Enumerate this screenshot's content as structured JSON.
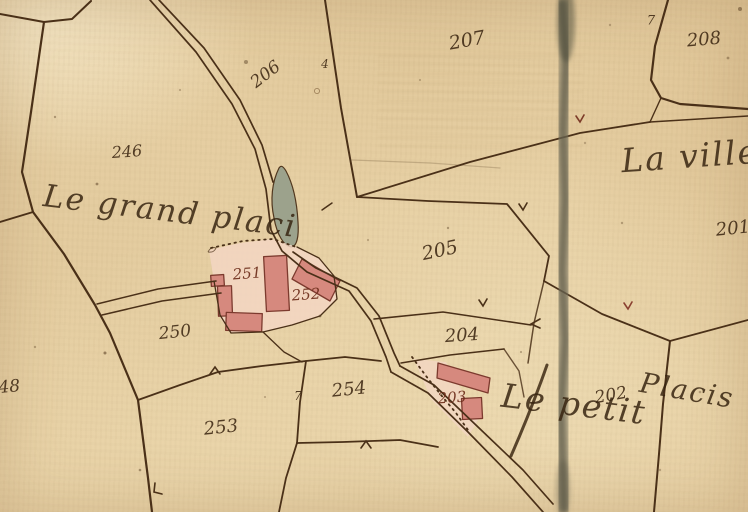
{
  "map": {
    "kind": "historical cadastral map (hand-drawn parchment)",
    "place_names": {
      "grand_place": "Le grand placi",
      "la_ville": "La ville",
      "le_petit": "Le petit",
      "placis": "Placis"
    },
    "parcels": {
      "p201": "201",
      "p202": "202",
      "p203": "203",
      "p204": "204",
      "p205": "205",
      "p206": "206",
      "p207": "207",
      "p208": "208",
      "p246": "246",
      "p248": "248",
      "p250": "250",
      "p251": "251",
      "p252": "252",
      "p253": "253",
      "p254": "254"
    },
    "survey_marks": {
      "seven_near_208": "7",
      "seven_near_254": "7",
      "four_near_206": "4"
    },
    "colors": {
      "paper": "#e7d0a4",
      "ink": "#4a3018",
      "building_fill": "#d6897e",
      "building_outline": "#7c3a2e",
      "courtyard": "#f3d6c3",
      "pond": "#99a08b",
      "red_ink": "#6c2c1a",
      "fold_crease": "#56533f"
    }
  }
}
